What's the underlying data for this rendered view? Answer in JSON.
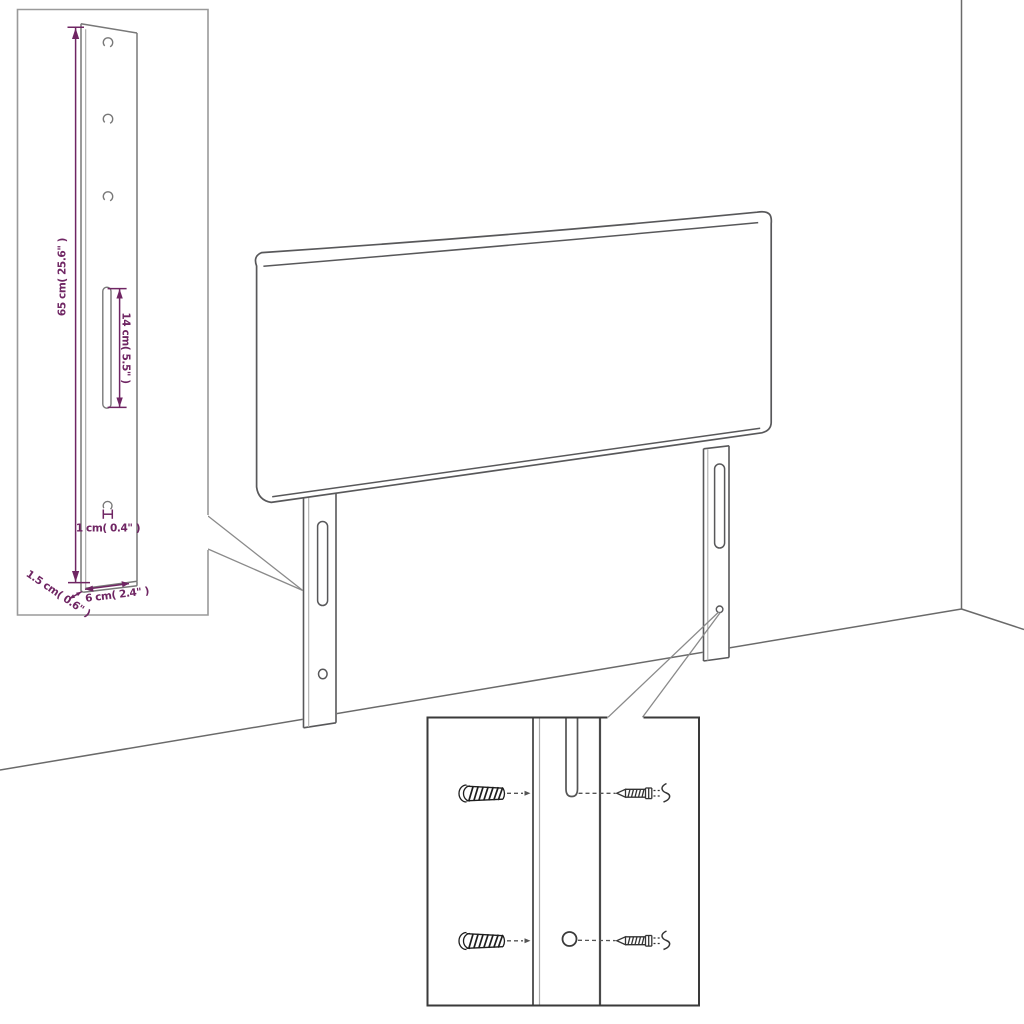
{
  "diagram": {
    "type": "product-dimension-diagram",
    "subject": "upholstered headboard with two slotted wall-mount legs, room corner backdrop, leg detail inset and wall-plug/screw mounting inset",
    "dimensions": {
      "leg_height": {
        "label": "65 cm( 25.6\" )"
      },
      "slot_length": {
        "label": "14 cm( 5.5\" )"
      },
      "hole_diameter": {
        "label": "1 cm( 0.4\" )"
      },
      "leg_thickness": {
        "label": "1.5 cm( 0.6\" )"
      },
      "leg_width": {
        "label": "6 cm( 2.4\" )"
      }
    },
    "colors": {
      "outline_gray": "#58585a",
      "light_gray": "#ababab",
      "annotation_purple": "#6f2563",
      "inset_leg_border": "#9a9a9a",
      "inset_mount_border": "#3a3a3a",
      "background": "#ffffff"
    },
    "icons": [
      "wall-plug-icon",
      "screw-icon",
      "rotate-squiggle-icon"
    ]
  }
}
